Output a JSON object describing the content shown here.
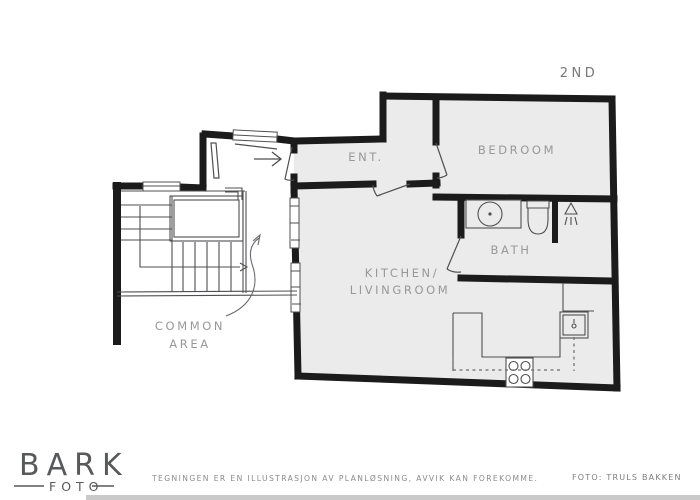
{
  "plan": {
    "floor_label": "2ND",
    "rooms": {
      "entrance": "ENT.",
      "bedroom": "BEDROOM",
      "bath": "BATH",
      "kitchen_lines": [
        "KITCHEN/",
        "LIVINGROOM"
      ],
      "common_lines": [
        "COMMON",
        "AREA"
      ]
    },
    "fixtures": [
      "sink",
      "toilet",
      "shower",
      "stove",
      "kitchen-sink",
      "tall-cabinet",
      "stairs"
    ]
  },
  "branding": {
    "logo_main": "BARK",
    "logo_sub": "FOTO"
  },
  "footer": {
    "disclaimer": "TEGNINGEN ER EN ILLUSTRASJON AV PLANLØSNING, AVVIK KAN FOREKOMME.",
    "photo_credit": "FOTO:  TRULS BAKKEN"
  },
  "colors": {
    "wall": "#1b1b1b",
    "floor": "#ebebec",
    "line": "#4f4f51",
    "dashed": "#6e6e70",
    "label": "#98989a",
    "scrollbar": "#c9c9c9"
  }
}
